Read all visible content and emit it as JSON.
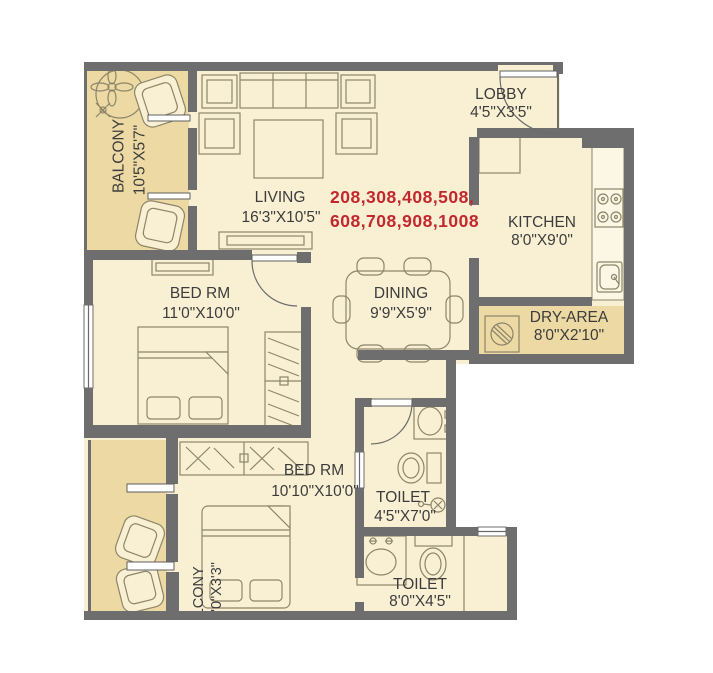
{
  "plan_type": "apartment-floor-plan",
  "unit_numbers": {
    "line1": "208,308,408,508,",
    "line2": "608,708,908,1008",
    "color": "#c1292e"
  },
  "rooms": [
    {
      "id": "balcony-1",
      "label": "BALCONY",
      "dims": "10'5\"X5'7\""
    },
    {
      "id": "living",
      "label": "LIVING",
      "dims": "16'3\"X10'5\""
    },
    {
      "id": "lobby",
      "label": "LOBBY",
      "dims": "4'5\"X3'5\""
    },
    {
      "id": "kitchen",
      "label": "KITCHEN",
      "dims": "8'0\"X9'0\""
    },
    {
      "id": "dry-area",
      "label": "DRY-AREA",
      "dims": "8'0\"X2'10\""
    },
    {
      "id": "bedroom-1",
      "label": "BED RM",
      "dims": "11'0\"X10'0\""
    },
    {
      "id": "dining",
      "label": "DINING",
      "dims": "9'9\"X5'9\""
    },
    {
      "id": "bedroom-2",
      "label": "BED RM",
      "dims": "10'10\"X10'0\""
    },
    {
      "id": "toilet-1",
      "label": "TOILET",
      "dims": "4'5\"X7'0\""
    },
    {
      "id": "toilet-2",
      "label": "TOILET",
      "dims": "8'0\"X4'5\""
    },
    {
      "id": "balcony-2",
      "label": "BALCONY",
      "dims": "10'0\"X3'3\"",
      "partially_visible": true
    }
  ],
  "colors": {
    "wall": "#6e6e6e",
    "floor": "#f9f0d4",
    "balcony_floor": "#ecd9a4",
    "furniture_line": "#8d8569",
    "label_text": "#3c3c3c",
    "unit_numbers_red": "#c1292e",
    "background": "#ffffff"
  }
}
